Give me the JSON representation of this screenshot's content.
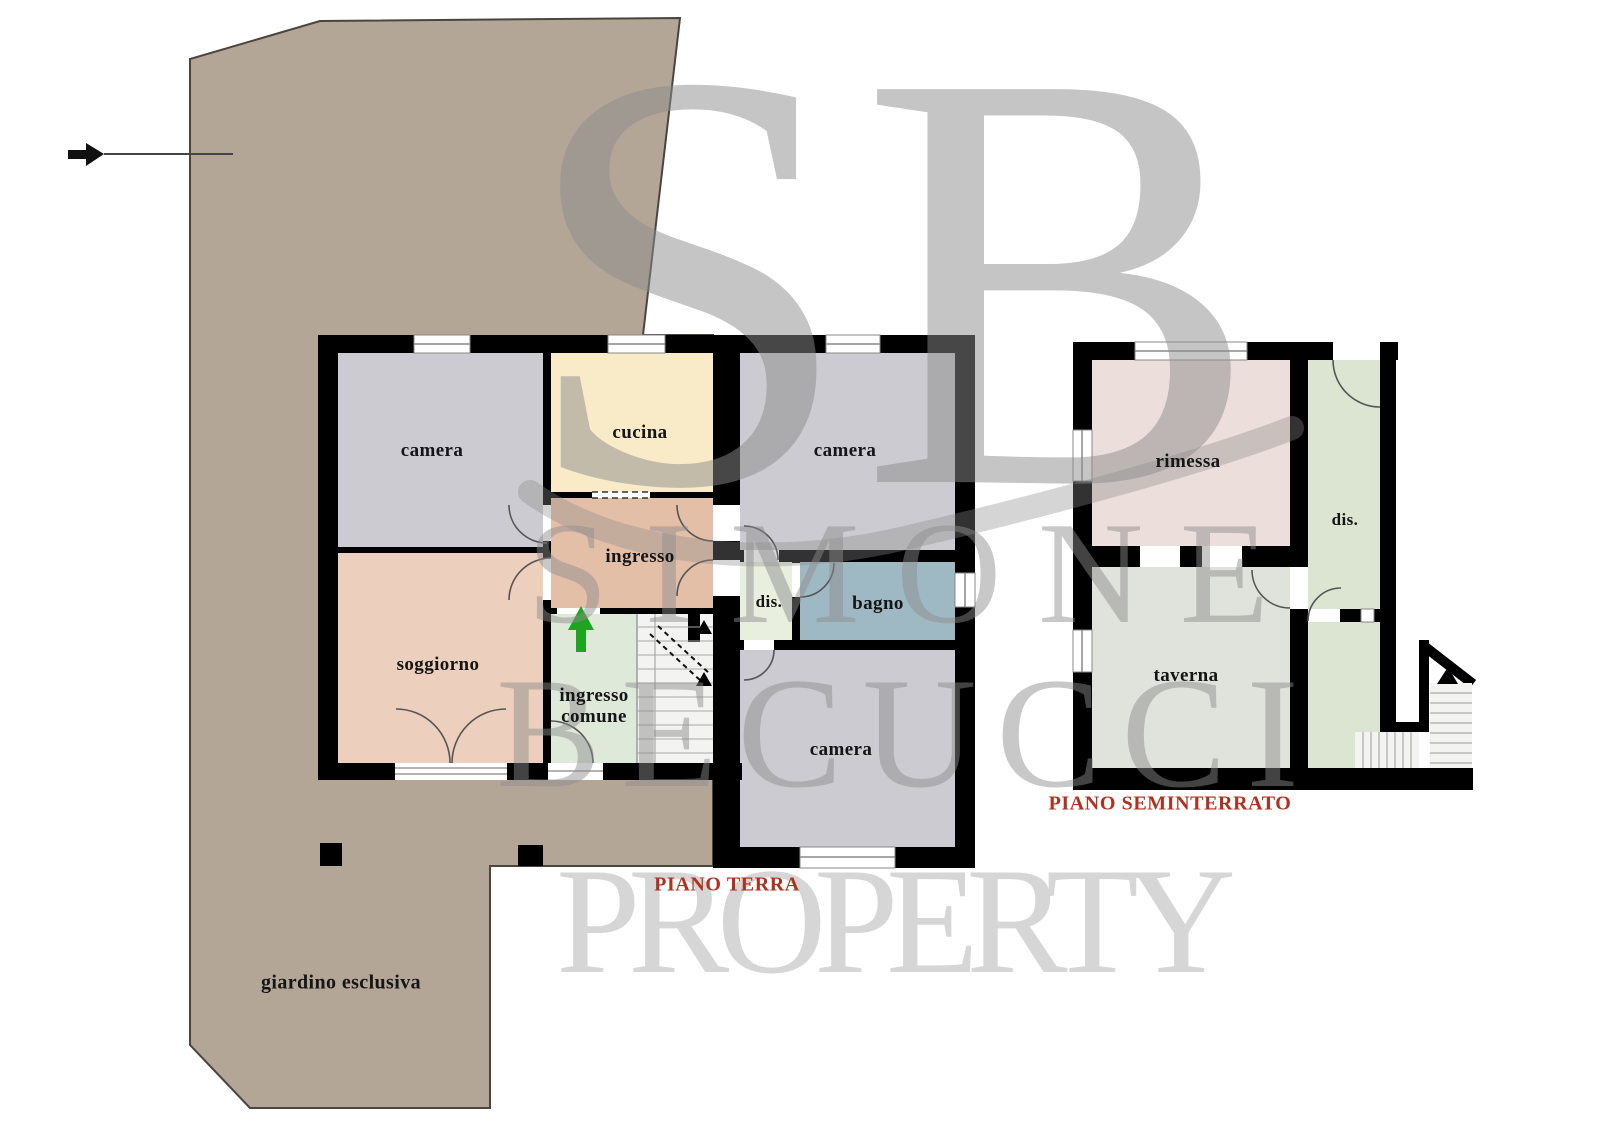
{
  "plan": {
    "floors": {
      "ground": {
        "label": "PIANO TERRA"
      },
      "basement": {
        "label": "PIANO SEMINTERRATO"
      }
    },
    "rooms": {
      "camera_nw": "camera",
      "cucina": "cucina",
      "camera_ne": "camera",
      "ingresso": "ingresso",
      "dis_gf": "dis.",
      "bagno": "bagno",
      "soggiorno": "soggiorno",
      "ingresso_comune": "ingresso comune",
      "camera_s": "camera",
      "giardino": "giardino esclusiva",
      "rimessa": "rimessa",
      "dis_basement": "dis.",
      "taverna": "taverna"
    }
  },
  "watermark": {
    "initials": "SB",
    "first_name": "SIMONE",
    "last_name": "BECUCCI",
    "word": "PROPERTY"
  },
  "colors": {
    "garden": "#b4a697",
    "camera": "#cbcbd1",
    "cucina": "#f9eac8",
    "ingresso": "#e4bfa8",
    "soggiorno": "#eccfbd",
    "ingresso_comune": "#dfe9d9",
    "stairwell": "#f3f3f1",
    "dis_gf": "#e9efde",
    "bagno": "#9fb9c4",
    "rimessa": "#ecdedb",
    "dis_basement": "#dbe5d1",
    "landing": "#dbe5d1",
    "taverna": "#e0e3db",
    "wall": "#000000",
    "title_red": "#b1301f",
    "watermark_gray": "#8d8d8d",
    "arrow_green": "#1ea41e"
  }
}
